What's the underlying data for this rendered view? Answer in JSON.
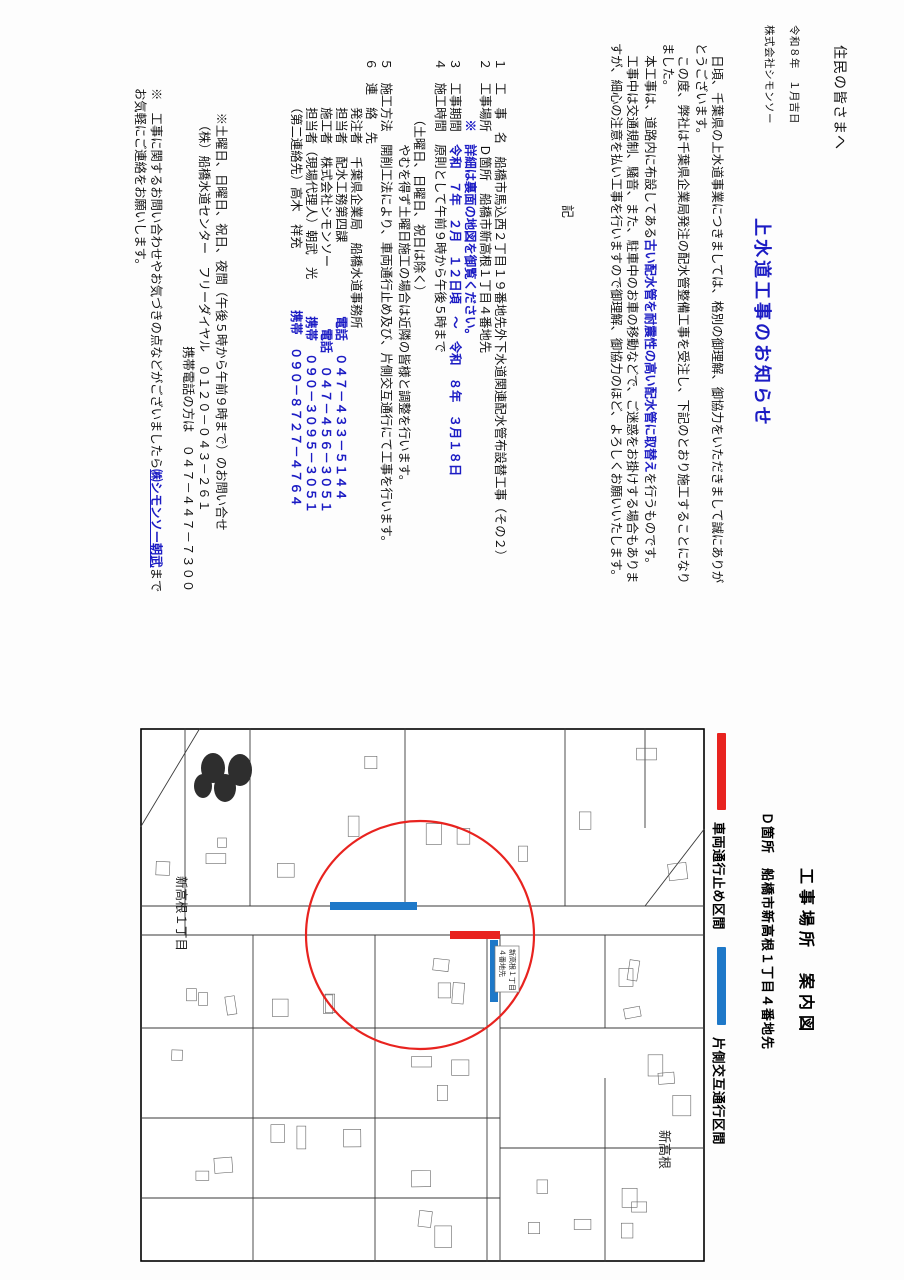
{
  "colors": {
    "accent_blue": "#1c1cc4",
    "legend_red": "#e8231f",
    "legend_blue": "#1e78c8"
  },
  "letter": {
    "greeting": "住民の皆さまへ",
    "date": "令和８年　１月吉日",
    "company": "株式会社シモンソー",
    "title": "上水道工事のお知らせ",
    "p1": "　日頃、千葉県の上水道事業につきましては、格別の御理解、御協力をいただきまして誠にありがとうございます。",
    "p2": "　この度、弊社は千葉県企業局発注の配水管整備工事を受注し、下記のとおり施工することになりました。",
    "p3_pre": "　本工事は、道路内に布設してある",
    "p3_em": "古い配水管を耐震性の高い配水管に取替え",
    "p3_post": "を行うものです。",
    "p4": "　工事中は交通規制、騒音、また、駐車中のお車の移動などで、ご迷惑をお掛けする場合もありますが、細心の注意を払い工事を行いますので御理解、御協力のほど、よろしくお願いいたします。",
    "ki": "記",
    "items": [
      [
        {
          "t": "１　工　事　名　船橋市馬込西２丁目１９番地先外下水道関連配水管布設替工事（その２）"
        }
      ],
      [
        {
          "t": "２　工事場所　Ｄ箇所　船橋市新高根１丁目４番地先"
        }
      ],
      [
        {
          "t": "　　　　　"
        },
        {
          "t": "※　詳細は裏面の地図を御覧ください。",
          "em": true
        }
      ],
      [
        {
          "t": "３　工事期間　"
        },
        {
          "t": "令和　７年　２月　１２日頃　～　令和　８年　３月１８日",
          "em": true
        }
      ],
      [
        {
          "t": "４　施工時間　原則として午前９時から午後５時まで"
        }
      ],
      [
        {
          "t": "　　　　　（土曜日、日曜日、祝日は除く）"
        }
      ],
      [
        {
          "t": "　　　　　　　やむを得ず土曜日施工の場合は近隣の皆様と調整を行います。"
        }
      ],
      [
        {
          "t": "５　施工方法　開削工法により、車両通行止め及び、片側交互通行にて工事を行います。"
        }
      ],
      [
        {
          "t": "６　連　絡　先"
        }
      ],
      [
        {
          "t": "　　　　発注者　千葉県企業局　船橋水道事務所"
        }
      ],
      [
        {
          "t": "　　　　担当者　配水工務第四課"
        },
        {
          "t": "　　　　　　電話　０４７－４３３－５１４４",
          "em": true
        }
      ],
      [
        {
          "t": "　　　　施工者　株式会社シモンソー"
        },
        {
          "t": "　　　　　電話　０４７－４５６－３０５１",
          "em": true
        }
      ],
      [
        {
          "t": "　　　　担当者（現場代理人）朝武　光"
        },
        {
          "t": "　　　携帯　０９０－３０９５－３０５１",
          "em": true
        }
      ],
      [
        {
          "t": "　　　　（第二連絡先）高木　祥充"
        },
        {
          "t": "　　　　　携帯　０９０－８７２７－４７６４",
          "em": true
        }
      ]
    ],
    "notes": [
      [
        {
          "t": "　　※土曜日、日曜日、祝日、夜間（午後５時から午前９時まで）のお問い合せ"
        }
      ],
      [
        {
          "t": "　　　（株）船橋水道センター　フリーダイヤル　０１２０－０４３－２６１"
        }
      ],
      [
        {
          "t": "　　　　　　　　　　　　　　　　　　　　　携帯電話の方は　０４７－４４７－７３００"
        }
      ]
    ],
    "note_final_pre": "※　工事に関するお問い合わせやお気づきの点などがございましたら",
    "note_final_link": "㈱シモンソー朝武",
    "note_final_post": "までお気軽にご連絡をお願いします。"
  },
  "map_section": {
    "caption": "工事場所　案内図",
    "location": "Ｄ箇所　船橋市新高根１丁目４番地先",
    "legend": [
      {
        "label": "車両通行止め区間",
        "color": "#e8231f"
      },
      {
        "label": "片側交互通行区間",
        "color": "#1e78c8"
      }
    ],
    "label_district": "新高根１丁目",
    "label_district2": "新高根",
    "callout_l1": "新高根１丁目",
    "callout_l2": "４番地先"
  }
}
